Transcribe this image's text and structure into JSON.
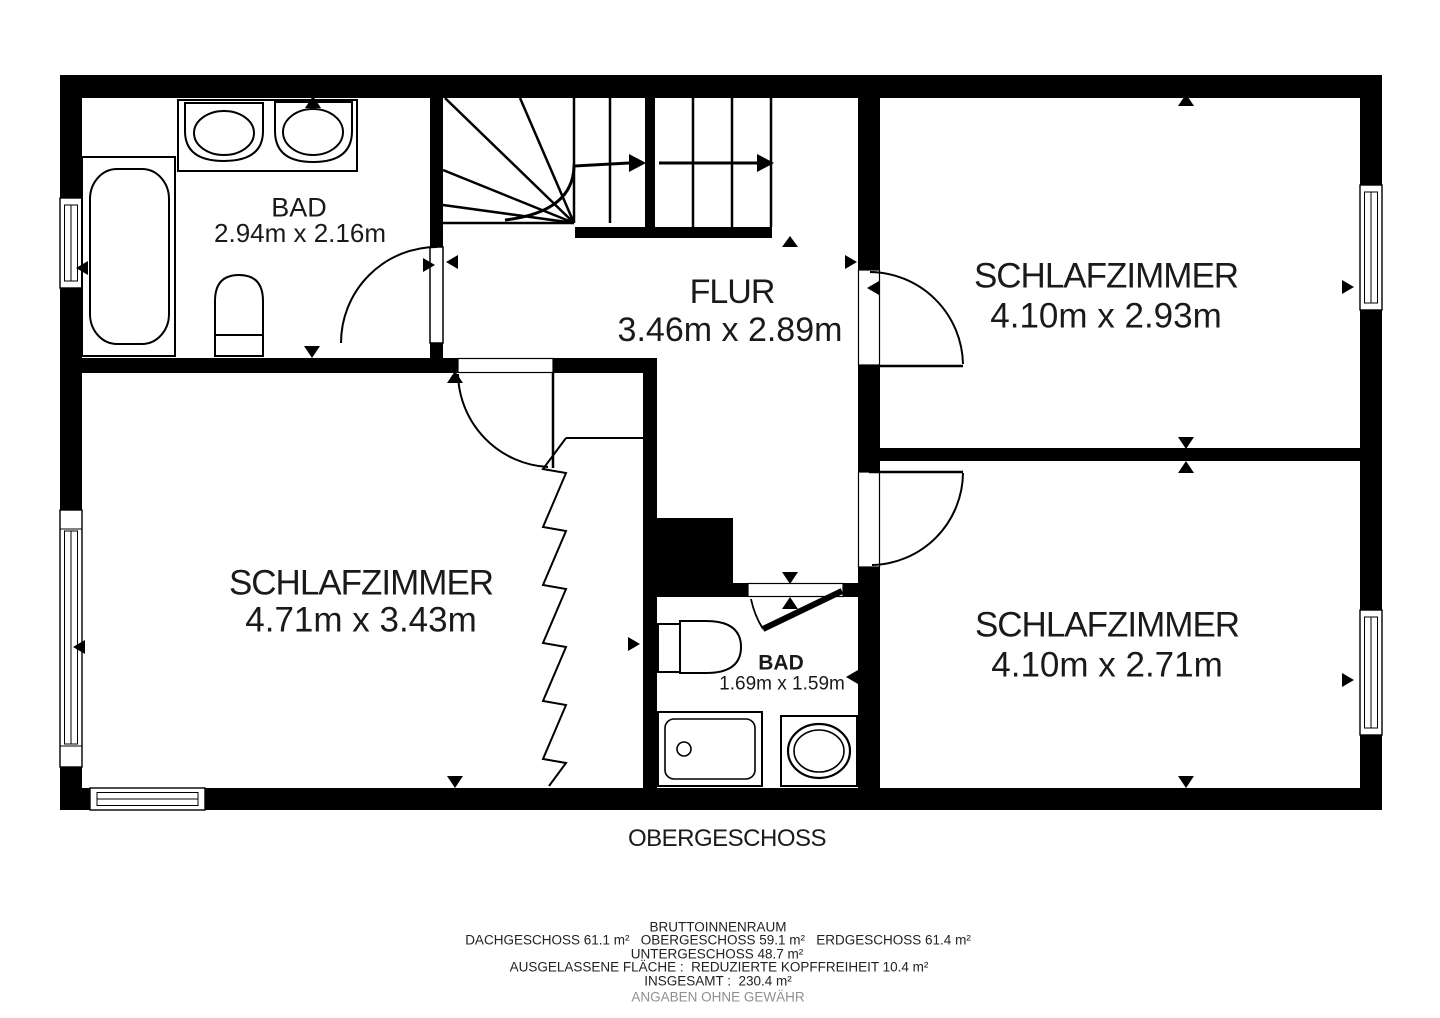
{
  "floor_title": "OBERGESCHOSS",
  "rooms": [
    {
      "name": "BAD",
      "dims": "2.94m x 2.16m"
    },
    {
      "name": "FLUR",
      "dims": "3.46m x 2.89m"
    },
    {
      "name": "SCHLAFZIMMER",
      "dims": "4.10m x 2.93m"
    },
    {
      "name": "SCHLAFZIMMER",
      "dims": "4.71m x 3.43m"
    },
    {
      "name": "SCHLAFZIMMER",
      "dims": "4.10m x 2.71m"
    },
    {
      "name": "BAD",
      "dims": "1.69m x 1.59m"
    }
  ],
  "summary": {
    "heading": "BRUTTOINNENRAUM",
    "lines": [
      "DACHGESCHOSS 61.1 m²   OBERGESCHOSS 59.1 m²   ERDGESCHOSS 61.4 m²",
      "UNTERGESCHOSS 48.7 m²",
      "AUSGELASSENE FLÄCHE :  REDUZIERTE KOPFFREIHEIT 10.4 m²",
      "INSGESAMT :  230.4 m²"
    ],
    "disclaimer": "ANGABEN OHNE GEWÄHR"
  },
  "colors": {
    "wall": "#000000",
    "background": "#ffffff",
    "text": "#1a1a1a",
    "disclaimer_text": "#8f8f8f"
  }
}
